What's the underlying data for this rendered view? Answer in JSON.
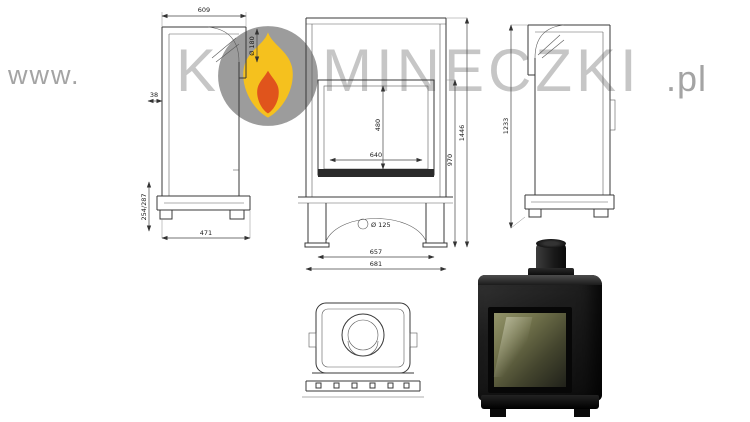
{
  "watermark": {
    "prefix": "www.",
    "brand_start": "K",
    "brand_end": "MINECZKI",
    "suffix": ".pl"
  },
  "palette": {
    "flame_yellow": "#f5c11e",
    "flame_orange": "#e0541c",
    "logo_circle_gray": "#9c9c9c",
    "watermark_gray": "#c6c6c6",
    "drawing_line": "#383838",
    "photo_black": "#0c0c0c"
  },
  "drawing": {
    "views": {
      "side_left": {
        "dims": {
          "top_width": "609",
          "flue_diameter": "Ø 180",
          "mount_offset": "38",
          "base_height_range": "254/287",
          "depth": "471"
        }
      },
      "front": {
        "dims": {
          "glass_width": "640",
          "glass_height": "480",
          "opening_height": "970",
          "total_height": "1446",
          "inner_width": "657",
          "total_width": "681",
          "air_inlet_diameter": "Ø 125"
        }
      },
      "side_right": {
        "dims": {
          "body_height": "1233"
        }
      }
    }
  }
}
